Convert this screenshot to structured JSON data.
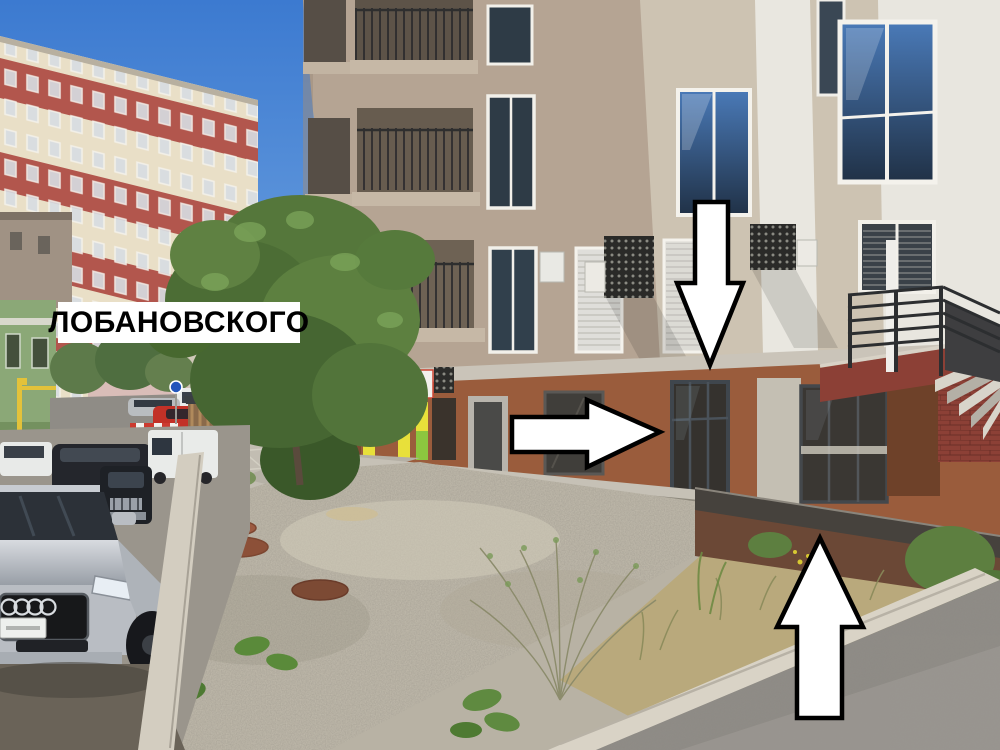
{
  "annotation": {
    "street_label": "ЛОБАНОВСКОГО",
    "arrows": [
      {
        "name": "down-arrow",
        "direction": "down"
      },
      {
        "name": "right-arrow",
        "direction": "right"
      },
      {
        "name": "up-arrow",
        "direction": "up"
      }
    ],
    "style": {
      "arrow_fill": "#ffffff",
      "arrow_outline": "#000000",
      "label_background": "#ffffff",
      "label_text_color": "#000000"
    }
  },
  "scene": {
    "colors": {
      "sky_top": "#3c7ad0",
      "sky_horizon": "#7fb0e6",
      "left_building_wall": "#e9dfc7",
      "left_building_stripe": "#b2564d",
      "green_house": "#8ba877",
      "gas_pipe": "#e3c23a",
      "main_facade": "#b5a493",
      "main_facade_light": "#cdc3b2",
      "white_facade": "#e8e6df",
      "lintel_band": "#cac4b9",
      "ground_floor": "#9a5c3c",
      "storefront_glass": "#3c3b37",
      "sign_green": "#8cc63f",
      "sign_yellow": "#e8e03a",
      "ramp_concrete": "#c6c1b6",
      "stair_brick": "#8c4036",
      "railing": "#2c2e30",
      "gravel": "#c3bdae",
      "dry_grass": "#b9a97c",
      "tree_green": "#55773b",
      "asphalt": "#908d88",
      "curb": "#d9d3c6",
      "car_silver": "#b9bdc3",
      "car_dark": "#24262c",
      "van_white": "#e9ebe9",
      "car_red": "#c23127"
    }
  }
}
